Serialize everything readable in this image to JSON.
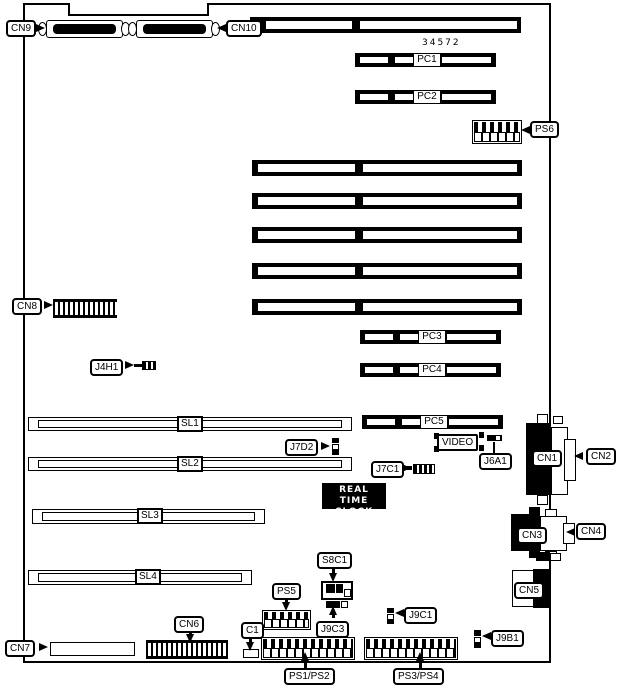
{
  "part_number": "34572",
  "rtc": {
    "line1": "REAL TIME",
    "line2": "CLOCK"
  },
  "labels": {
    "cn9": "CN9",
    "cn10": "CN10",
    "pc1": "PC1",
    "pc2": "PC2",
    "pc3": "PC3",
    "pc4": "PC4",
    "pc5": "PC5",
    "ps6": "PS6",
    "cn8": "CN8",
    "j4h1": "J4H1",
    "sl1": "SL1",
    "sl2": "SL2",
    "sl3": "SL3",
    "sl4": "SL4",
    "j7d2": "J7D2",
    "j7c1": "J7C1",
    "video": "VIDEO",
    "j6a1": "J6A1",
    "cn1": "CN1",
    "cn2": "CN2",
    "cn3": "CN3",
    "cn4": "CN4",
    "cn5": "CN5",
    "s8c1": "S8C1",
    "ps5": "PS5",
    "c1": "C1",
    "j9c3": "J9C3",
    "j9c1": "J9C1",
    "j9b1": "J9B1",
    "cn6": "CN6",
    "cn7": "CN7",
    "ps1_ps2": "PS1/PS2",
    "ps3_ps4": "PS3/PS4"
  },
  "colors": {
    "foreground": "#000000",
    "background": "#ffffff"
  }
}
